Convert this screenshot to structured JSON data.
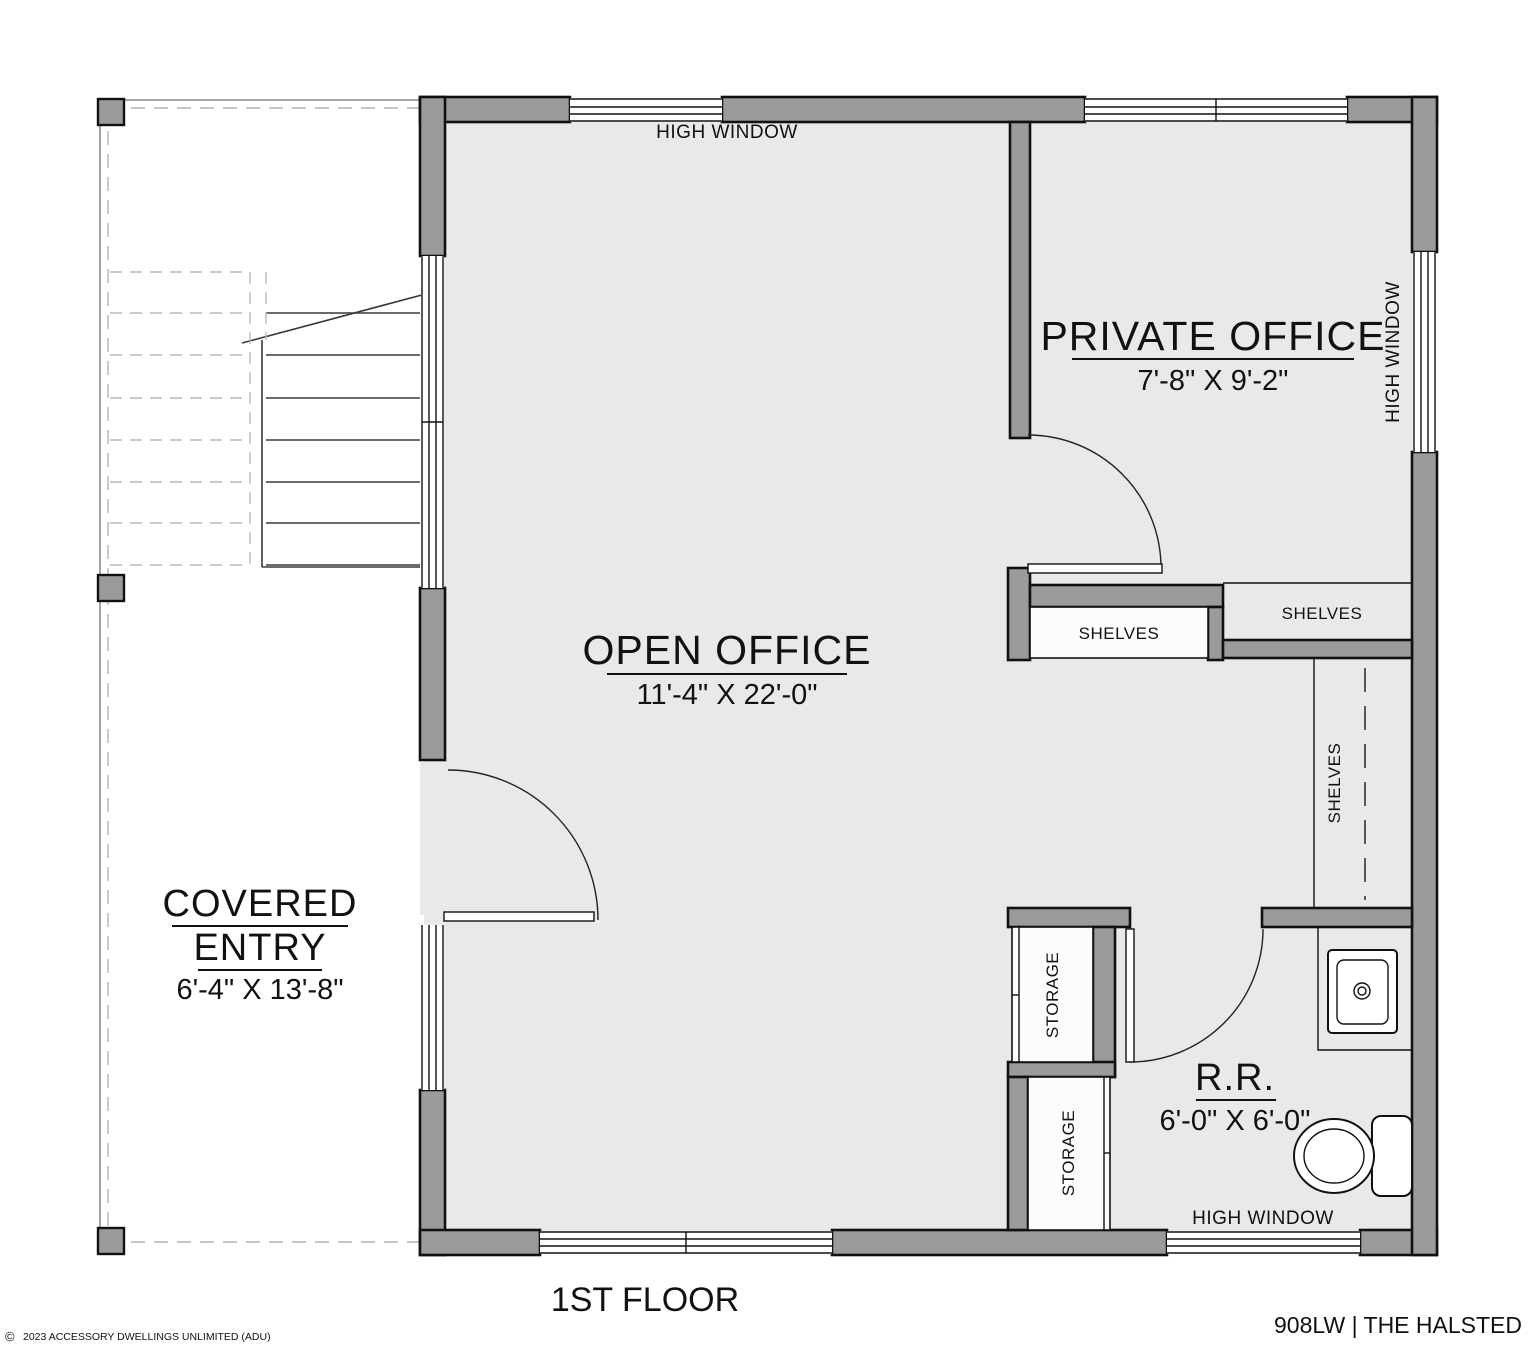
{
  "meta": {
    "floor_title": "1ST FLOOR",
    "plan_code": "908LW | THE HALSTED",
    "copyright_symbol": "©",
    "copyright_text": "2023 ACCESSORY DWELLINGS UNLIMITED (ADU)"
  },
  "rooms": {
    "open_office": {
      "name": "OPEN OFFICE",
      "dims": "11'-4\" X 22'-0\""
    },
    "private_office": {
      "name": "PRIVATE OFFICE",
      "dims": "7'-8\" X 9'-2\""
    },
    "covered_entry": {
      "name_line1": "COVERED",
      "name_line2": "ENTRY",
      "dims": "6'-4\" X 13'-8\""
    },
    "restroom": {
      "name": "R.R.",
      "dims": "6'-0\" X 6'-0\""
    }
  },
  "annotations": {
    "high_window_top": "HIGH WINDOW",
    "high_window_right": "HIGH WINDOW",
    "high_window_bottom": "HIGH WINDOW",
    "shelves_open_side": "SHELVES",
    "shelves_private_side": "SHELVES",
    "shelves_tall": "SHELVES",
    "storage_upper": "STORAGE",
    "storage_lower": "STORAGE"
  },
  "colors": {
    "wall_fill": "#9b9b9b",
    "floor_fill": "#e9e9e9",
    "line": "#111111",
    "background": "#ffffff"
  }
}
